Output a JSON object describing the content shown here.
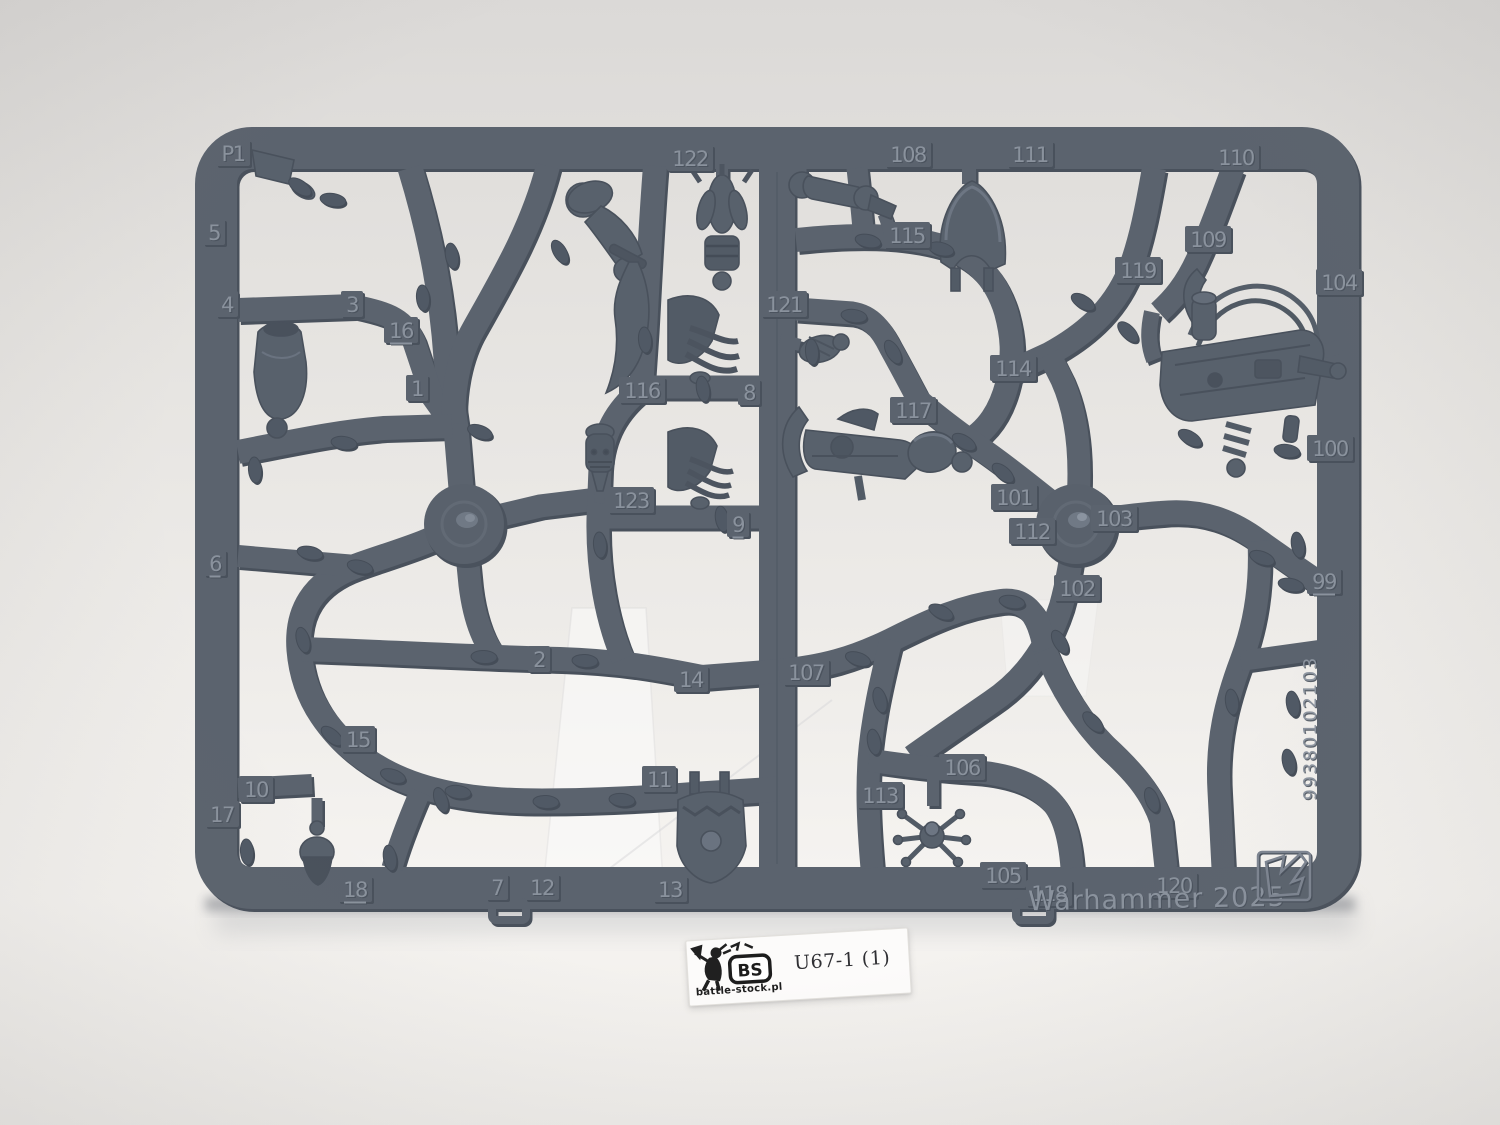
{
  "photo_subject": "Warhammer plastic model sprue standing on a white backdrop",
  "sprue": {
    "plastic_color": "#5b636e",
    "plastic_dark": "#49515c",
    "part_color": "#58616c",
    "emboss_color": "#8a929d",
    "brand_text": "Warhammer 2025",
    "serial_code": "99380102103",
    "part_labels": [
      {
        "label": "P1",
        "x": 233,
        "y": 154
      },
      {
        "label": "5",
        "x": 214,
        "y": 233
      },
      {
        "label": "4",
        "x": 227,
        "y": 305
      },
      {
        "label": "3",
        "x": 352,
        "y": 305
      },
      {
        "label": "16",
        "x": 401,
        "y": 331,
        "u": true
      },
      {
        "label": "1",
        "x": 417,
        "y": 389
      },
      {
        "label": "6",
        "x": 215,
        "y": 564,
        "u": true
      },
      {
        "label": "122",
        "x": 690,
        "y": 159
      },
      {
        "label": "116",
        "x": 642,
        "y": 391
      },
      {
        "label": "8",
        "x": 749,
        "y": 393
      },
      {
        "label": "123",
        "x": 631,
        "y": 501
      },
      {
        "label": "9",
        "x": 738,
        "y": 525,
        "u": true
      },
      {
        "label": "121",
        "x": 784,
        "y": 305
      },
      {
        "label": "108",
        "x": 908,
        "y": 155
      },
      {
        "label": "115",
        "x": 907,
        "y": 236
      },
      {
        "label": "111",
        "x": 1030,
        "y": 155
      },
      {
        "label": "110",
        "x": 1236,
        "y": 158
      },
      {
        "label": "109",
        "x": 1208,
        "y": 240
      },
      {
        "label": "119",
        "x": 1138,
        "y": 271
      },
      {
        "label": "104",
        "x": 1339,
        "y": 283
      },
      {
        "label": "114",
        "x": 1013,
        "y": 369
      },
      {
        "label": "117",
        "x": 913,
        "y": 411
      },
      {
        "label": "101",
        "x": 1014,
        "y": 498
      },
      {
        "label": "112",
        "x": 1032,
        "y": 532
      },
      {
        "label": "103",
        "x": 1114,
        "y": 519
      },
      {
        "label": "102",
        "x": 1077,
        "y": 589
      },
      {
        "label": "100",
        "x": 1330,
        "y": 449
      },
      {
        "label": "99",
        "x": 1324,
        "y": 582,
        "u": true
      },
      {
        "label": "2",
        "x": 539,
        "y": 660
      },
      {
        "label": "14",
        "x": 691,
        "y": 680
      },
      {
        "label": "107",
        "x": 806,
        "y": 673
      },
      {
        "label": "11",
        "x": 659,
        "y": 780
      },
      {
        "label": "106",
        "x": 962,
        "y": 768
      },
      {
        "label": "113",
        "x": 880,
        "y": 796
      },
      {
        "label": "15",
        "x": 358,
        "y": 740
      },
      {
        "label": "10",
        "x": 256,
        "y": 790
      },
      {
        "label": "17",
        "x": 222,
        "y": 815
      },
      {
        "label": "18",
        "x": 355,
        "y": 890,
        "u": true
      },
      {
        "label": "7",
        "x": 497,
        "y": 888
      },
      {
        "label": "12",
        "x": 542,
        "y": 888
      },
      {
        "label": "13",
        "x": 670,
        "y": 890
      },
      {
        "label": "105",
        "x": 1003,
        "y": 876
      },
      {
        "label": "118",
        "x": 1049,
        "y": 894
      },
      {
        "label": "120",
        "x": 1174,
        "y": 886
      }
    ]
  },
  "label_card": {
    "code": "U67-1 (1)",
    "stamp_monogram": "BS",
    "stamp_caption": "battle-stock.pl"
  },
  "icons": [
    {
      "name": "gw-arrow-logo"
    },
    {
      "name": "battle-stock-stamp"
    }
  ]
}
